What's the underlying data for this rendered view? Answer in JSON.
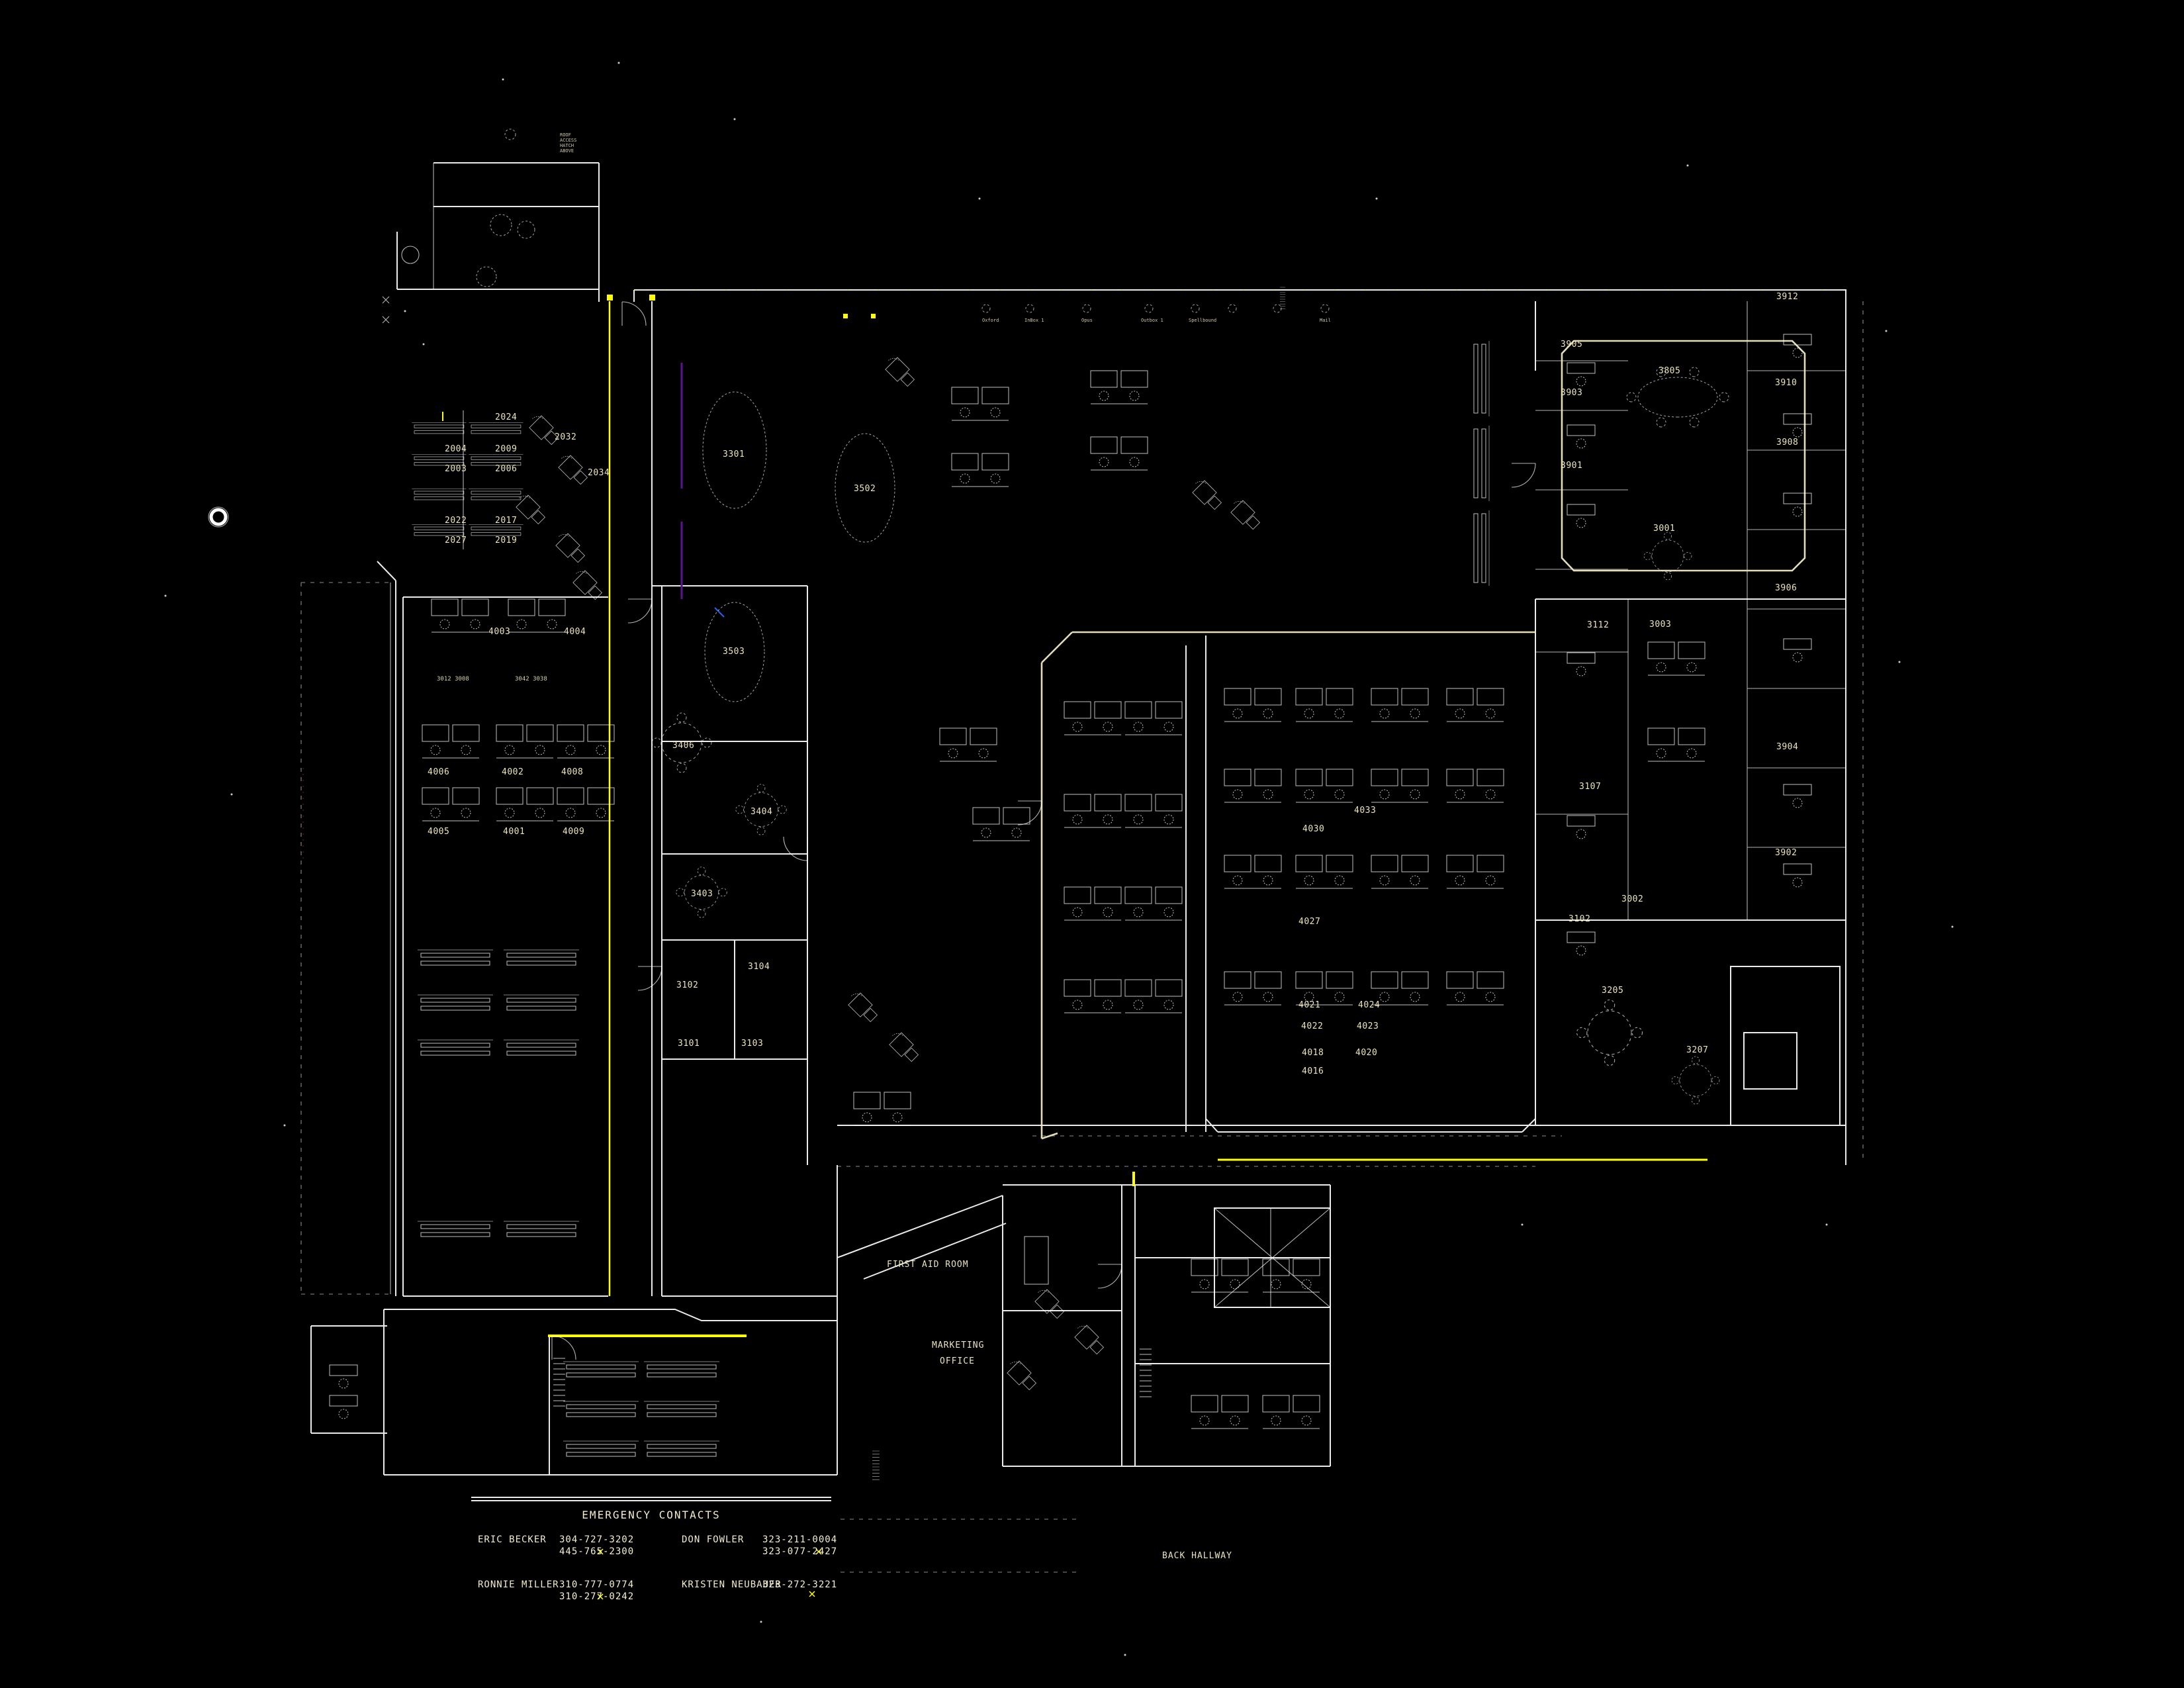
{
  "app": {
    "name": "CAD FLOOR PLAN - FURNITURE LEVEL",
    "background": "#000000"
  },
  "palette": {
    "line": "#ffffff",
    "accent_cream": "#efe8c0",
    "highlight_yellow": "#ffff00",
    "utility_purple": "#5a1492",
    "utility_blue": "#2563eb",
    "utility_red": "#6b1407",
    "label": "#ece5b8"
  },
  "contacts": {
    "title": "EMERGENCY CONTACTS",
    "entries": [
      {
        "name": "ERIC BECKER",
        "phone1": "304-727-3202",
        "phone2": "445-765-2300"
      },
      {
        "name": "DON FOWLER",
        "phone1": "323-211-0004",
        "phone2": "323-077-2427"
      },
      {
        "name": "RONNIE MILLER",
        "phone1": "310-777-0774",
        "phone2": "310-277-0242"
      },
      {
        "name": "KRISTEN NEUBAUER",
        "phone1": "323-272-3221",
        "phone2": ""
      }
    ]
  },
  "areas": {
    "first_aid": "FIRST AID ROOM",
    "marketing_l1": "MARKETING",
    "marketing_l2": "OFFICE",
    "back_hallway": "BACK HALLWAY"
  },
  "conference_names": {
    "c1": "Oxford",
    "c2": "InBox 1",
    "c3": "Opus",
    "c4": "Outbox 1",
    "c5": "Spellbound",
    "c6": "Mail"
  },
  "note": {
    "l1": "ROOF",
    "l2": "ACCESS",
    "l3": "HATCH",
    "l4": "ABOVE"
  },
  "rooms": {
    "left_block": [
      "2004",
      "2003",
      "2022",
      "2027",
      "2024",
      "2009",
      "2006",
      "2017",
      "2019",
      "2032",
      "2034"
    ],
    "west_office": [
      "4003",
      "4004",
      "3012  3008",
      "3042  3038",
      "4006",
      "4002",
      "4008",
      "4005",
      "4001",
      "4009"
    ],
    "center": [
      "3301",
      "3502",
      "3503",
      "3406",
      "3404",
      "3403",
      "3102",
      "3104",
      "3101",
      "3103"
    ],
    "east_office": [
      "4030",
      "4033",
      "4027",
      "4024",
      "4021",
      "4022",
      "4023",
      "4018",
      "4020",
      "4016"
    ],
    "right_wing": [
      "3905",
      "3903",
      "3901",
      "3112",
      "3107",
      "3102",
      "3805",
      "3001",
      "3003",
      "3002",
      "3912",
      "3910",
      "3908",
      "3906",
      "3904",
      "3902"
    ],
    "lower_right": [
      "3205",
      "3207"
    ]
  }
}
